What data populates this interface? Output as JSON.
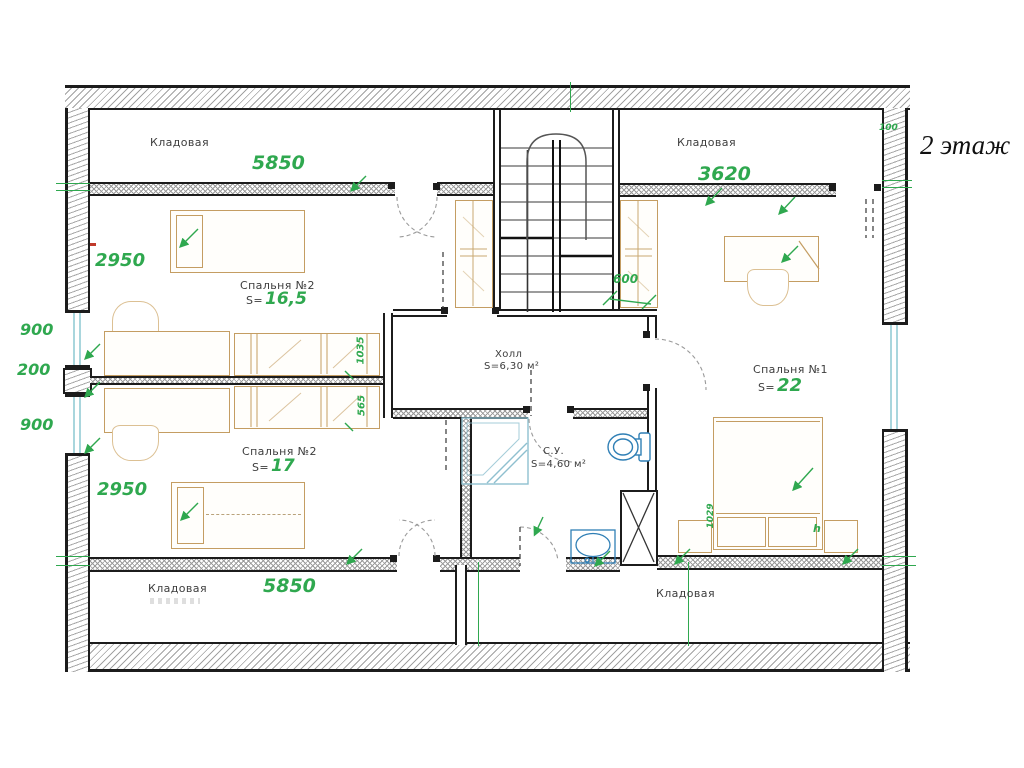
{
  "title": "2 этаж",
  "labels": {
    "storage_top_left": "Кладовая",
    "storage_top_right": "Кладовая",
    "storage_bottom_left": "Кладовая",
    "storage_bottom_right": "Кладовая",
    "area_prefix": "S=",
    "bedroom2_top_name": "Спальня №2",
    "bedroom2_top_area": "16,5",
    "bedroom2_bottom_name": "Спальня №2",
    "bedroom2_bottom_area": "17",
    "bedroom1_name": "Спальня №1",
    "bedroom1_area": "22",
    "hall_name": "Холл",
    "hall_area": "S=6,30 м²",
    "bathroom_name": "С.У.",
    "bathroom_area": "S=4,60 м²"
  },
  "dimensions": {
    "d5850_top": "5850",
    "d3620": "3620",
    "d2950_upper": "2950",
    "d900_upper": "900",
    "d200": "200",
    "d900_lower": "900",
    "d2950_lower": "2950",
    "d5850_bottom": "5850",
    "d600": "600",
    "d100": "100",
    "d1035": "1035",
    "d565": "565",
    "d1029": "1029",
    "dh": "h"
  },
  "colors": {
    "dimension_green": "#2fa84f",
    "furniture_tan": "#c49d62",
    "plumbing_blue": "#2f7fb5",
    "window_cyan": "#a9d6dd",
    "wall_black": "#1c1c1c"
  }
}
